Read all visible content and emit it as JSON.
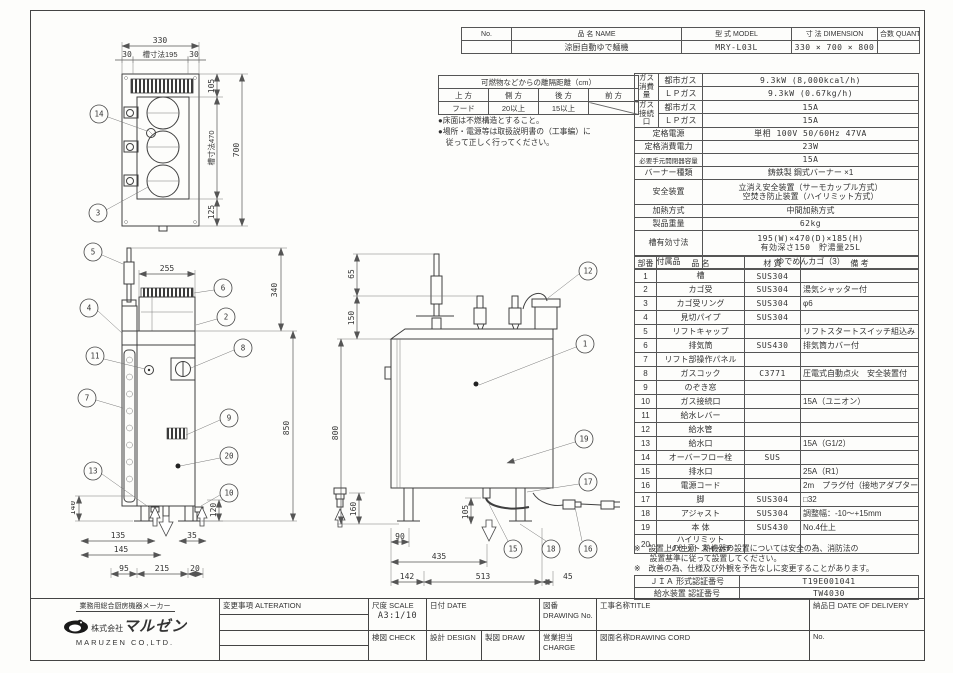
{
  "header_table": {
    "no_label": "No.",
    "name_label": "品 名 NAME",
    "model_label": "型 式 MODEL",
    "dimension_label": "寸 法 DIMENSION",
    "quantity_label": "合数 QUANTITY",
    "name_value": "涼厨自動ゆで麺機",
    "model_value": "MRY-L03L",
    "dimension_value": "330 × 700 × 800",
    "quantity_value": ""
  },
  "clearance": {
    "title": "可燃物などからの離隔距離（cm）",
    "headers": [
      "上 方",
      "側 方",
      "後 方",
      "前 方"
    ],
    "values": [
      "フード",
      "20以上",
      "15以上",
      ""
    ],
    "note1": "●床面は不燃構造とすること。",
    "note2": "●場所・電源等は取扱説明書の（工事編）に",
    "note3": "　従って正しく行ってください。"
  },
  "spec": {
    "gas_consumption_label": "ガス\n消費量",
    "city_gas": "都市ガス",
    "lp_gas": "ＬＰガス",
    "gas_city": "9.3kW (8,000kcal/h)",
    "gas_lp": "9.3kW (0.67kg/h)",
    "gas_connection_label": "ガス\n接続口",
    "conn_city": "15A",
    "conn_lp": "15A",
    "power_label": "定格電源",
    "power_value": "単相 100V 50/60Hz 47VA",
    "power_consumption_label": "定格消費電力",
    "power_consumption_value": "23W",
    "breaker_label": "必要手元開閉器容量",
    "breaker_value": "15A",
    "burner_label": "バーナー種類",
    "burner_value": "鋳鉄製 鋼式バーナー ×1",
    "safety_label": "安全装置",
    "safety_value": "立消え安全装置（サーモカップル方式）\n空焚き防止装置（ハイリミット方式）",
    "heating_label": "加熱方式",
    "heating_value": "中間加熱方式",
    "weight_label": "製品重量",
    "weight_value": "62kg",
    "tank_label": "槽有効寸法",
    "tank_value": "195(W)×470(D)×185(H)\n有効深さ150　貯湯量25L",
    "accessory_label": "付属品",
    "accessory_value": "ゆでめんカゴ（3）"
  },
  "parts": {
    "headers": [
      "部番",
      "品 名",
      "材 質",
      "備 考"
    ],
    "rows": [
      [
        "1",
        "槽",
        "SUS304",
        ""
      ],
      [
        "2",
        "カゴ受",
        "SUS304",
        "湯気シャッター付"
      ],
      [
        "3",
        "カゴ受リング",
        "SUS304",
        "φ6"
      ],
      [
        "4",
        "見切パイプ",
        "SUS304",
        ""
      ],
      [
        "5",
        "リフトキャップ",
        "",
        "リフトスタートスイッチ組込み"
      ],
      [
        "6",
        "排気筒",
        "SUS430",
        "排気筒カバー付"
      ],
      [
        "7",
        "リフト部操作パネル",
        "",
        ""
      ],
      [
        "8",
        "ガスコック",
        "C3771",
        "圧電式自動点火　安全装置付"
      ],
      [
        "9",
        "のぞき窓",
        "",
        ""
      ],
      [
        "10",
        "ガス接続口",
        "",
        "15A（ユニオン）"
      ],
      [
        "11",
        "給水レバー",
        "",
        ""
      ],
      [
        "12",
        "給水管",
        "",
        ""
      ],
      [
        "13",
        "給水口",
        "",
        "15A（G1/2）"
      ],
      [
        "14",
        "オーバーフロー栓",
        "SUS",
        ""
      ],
      [
        "15",
        "排水口",
        "",
        "25A（R1）"
      ],
      [
        "16",
        "電源コード",
        "",
        "2m　プラグ付（接地アダプター付）"
      ],
      [
        "17",
        "脚",
        "SUS304",
        "□32"
      ],
      [
        "18",
        "アジャスト",
        "SUS304",
        "調整幅：-10～+15mm"
      ],
      [
        "19",
        "本 体",
        "SUS430",
        "No.4仕上"
      ],
      [
        "20",
        "ハイリミット\nリセットスイッチ",
        "",
        ""
      ]
    ]
  },
  "footnotes": {
    "line1": "※　設置上の注意　熱機器の設置については安全の為、消防法の",
    "line2": "　　設置基準に従って設置してください。",
    "line3": "※　改善の為、仕様及び外観を予告なしに変更することがあります。"
  },
  "cert": {
    "jia_label": "ＪＩＡ 形式認証番号",
    "jia_value": "T19E001041",
    "water_label": "給水装置 認証番号",
    "water_value": "TW4030"
  },
  "title_block": {
    "tagline": "業務用総合厨房機器メーカー",
    "company_prefix": "株式会社",
    "company_name": "マルゼン",
    "company_en": "MARUZEN CO,LTD.",
    "alteration_label": "変更事項 ALTERATION",
    "scale_label": "尺度 SCALE",
    "scale_value": "A3:1/10",
    "date_label": "日付 DATE",
    "drawing_no_label": "図番 DRAWING No.",
    "title_label": "工事名称TITLE",
    "delivery_label": "納品日  DATE OF DELIVERY",
    "check_label": "検図 CHECK",
    "design_label": "設計 DESIGN",
    "draw_label": "製図 DRAW",
    "charge_label": "営業担当CHARGE",
    "cord_label": "図面名称DRAWING CORD",
    "no_label": "No."
  },
  "drawings": {
    "plan": {
      "d330": "330",
      "d30l": "30",
      "d195": "槽寸法195",
      "d30r": "30",
      "d105": "105",
      "d470": "槽寸法470",
      "d125": "125",
      "d700": "700",
      "b14": "14",
      "b3": "3"
    },
    "front": {
      "d255": "255",
      "d340": "340",
      "d850": "850",
      "d140": "140",
      "d120": "120",
      "d135": "135",
      "d145": "145",
      "d35": "35",
      "d95": "95",
      "d215": "215",
      "d20": "20",
      "b5": "5",
      "b4": "4",
      "b6": "6",
      "b2": "2",
      "b11": "11",
      "b7": "7",
      "b8": "8",
      "b9": "9",
      "b20": "20",
      "b13": "13",
      "b10": "10"
    },
    "side": {
      "d65": "65",
      "d150": "150",
      "d800": "800",
      "d160": "160",
      "d105": "105",
      "d90": "90",
      "d435": "435",
      "d142": "142",
      "d513": "513",
      "d45": "45",
      "b12": "12",
      "b1": "1",
      "b19": "19",
      "b17": "17",
      "b15": "15",
      "b18": "18",
      "b16": "16"
    }
  }
}
